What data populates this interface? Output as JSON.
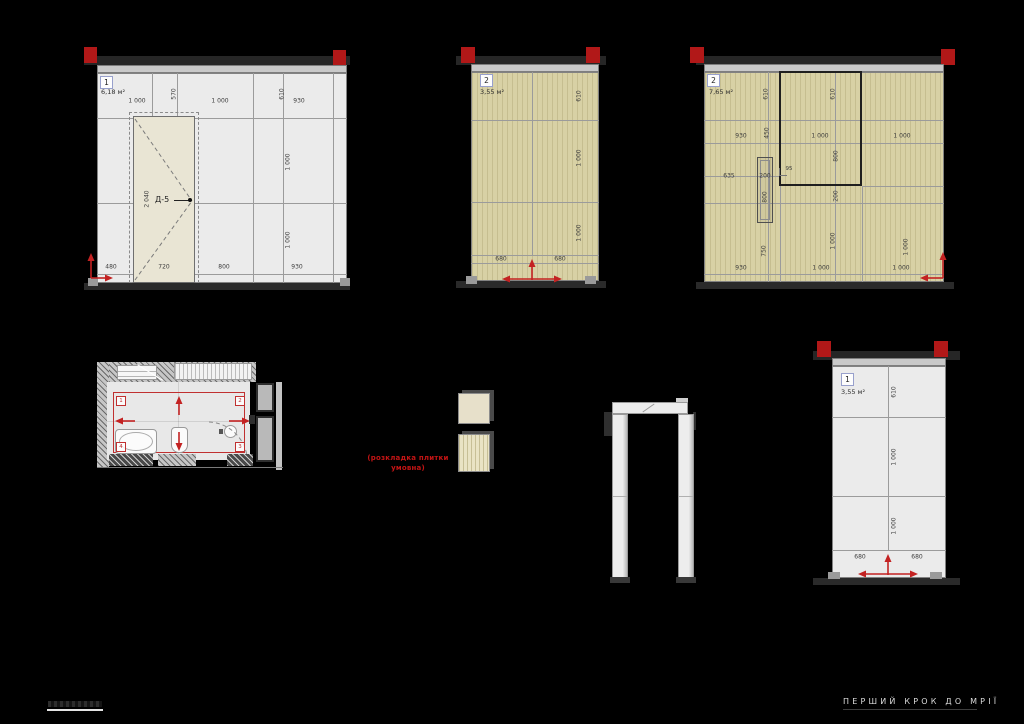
{
  "title_block": {
    "project_title": "ПЕРШИЙ КРОК ДО МРІЇ"
  },
  "note": {
    "line1": "(розкладка плитки",
    "line2": "умовна)"
  },
  "colors": {
    "marker_red": "#b11818",
    "arrow_red": "#c32222",
    "plan_red": "#c03030",
    "tile_beige": "#d8d1a5",
    "tile_gray": "#ebebeb"
  },
  "elevations": {
    "e1": {
      "tag": "1",
      "area": "6,18 м²",
      "door": {
        "label": "Д-5",
        "height": "2 040"
      },
      "dims": {
        "t1": "1 000",
        "t2": "570",
        "t3": "1 000",
        "t4": "610",
        "t5": "930",
        "r1": "1 000",
        "r2": "1 000",
        "b1": "480",
        "b2": "720",
        "b3": "800",
        "b4": "930"
      }
    },
    "e2": {
      "tag": "2",
      "area": "3,55 м²",
      "dims": {
        "r1": "610",
        "r2": "1 000",
        "r3": "1 000",
        "b1": "680",
        "b2": "680"
      }
    },
    "e3": {
      "tag": "2",
      "area": "7,65 м²",
      "dims": {
        "v610a": "610",
        "v610b": "610",
        "h930a": "930",
        "v450": "450",
        "h1000a": "1 000",
        "v800a": "800",
        "h1000b": "1 000",
        "h635": "635",
        "h200": "200",
        "h95": "95",
        "v800b": "800",
        "v200": "200",
        "v750": "750",
        "v1000a": "1 000",
        "v1000b": "1 000",
        "b930": "930",
        "b1000a": "1 000",
        "b1000b": "1 000"
      }
    },
    "e4": {
      "tag": "1",
      "area": "3,55 м²",
      "dims": {
        "r1": "610",
        "r2": "1 000",
        "r3": "1 000",
        "b1": "680",
        "b2": "680"
      }
    }
  },
  "plan": {
    "markers": {
      "m1": "1",
      "m2": "2",
      "m3": "3",
      "m4": "4"
    }
  }
}
